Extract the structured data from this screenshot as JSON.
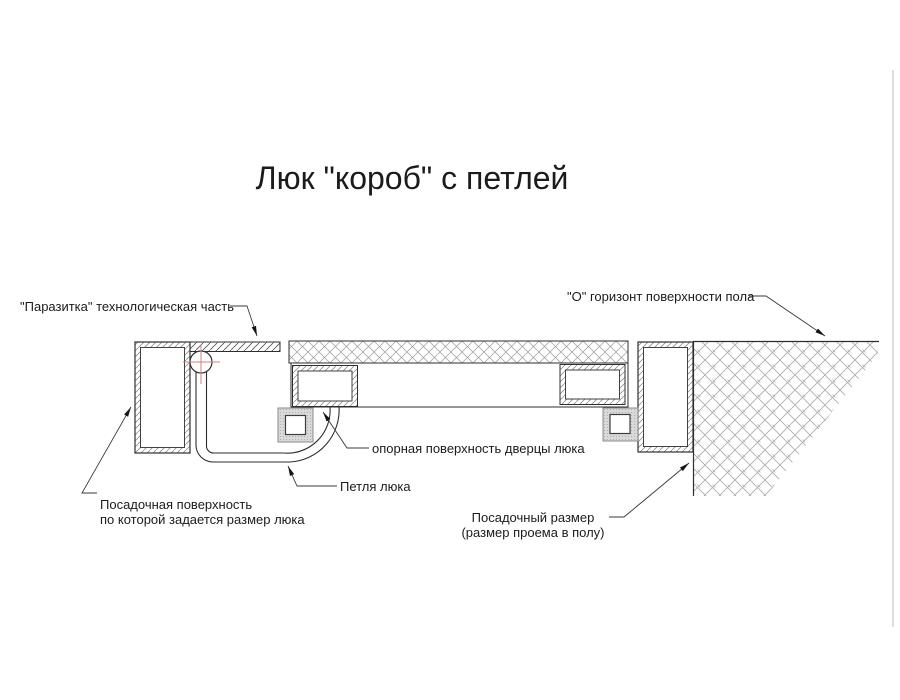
{
  "page": {
    "title": "Люк \"короб\" с петлей"
  },
  "drawing": {
    "labels": {
      "parasitka": "\"Паразитка\" технологическая часть",
      "floor_horizon": "\"О\" горизонт поверхности пола",
      "door_support_surface": "опорная поверхность дверцы люка",
      "hinge": "Петля люка",
      "seating_surface": [
        "Посадочная поверхность",
        "по которой задается размер люка"
      ],
      "seating_size": [
        "Посадочный размер",
        "(размер проема в полу)"
      ]
    },
    "colors": {
      "line": "#2e2e2e",
      "hatch": "#9a9a9a",
      "center_mark": "#d08078",
      "text": "#1b1b1b",
      "page_border": "#bdbdbd"
    }
  }
}
